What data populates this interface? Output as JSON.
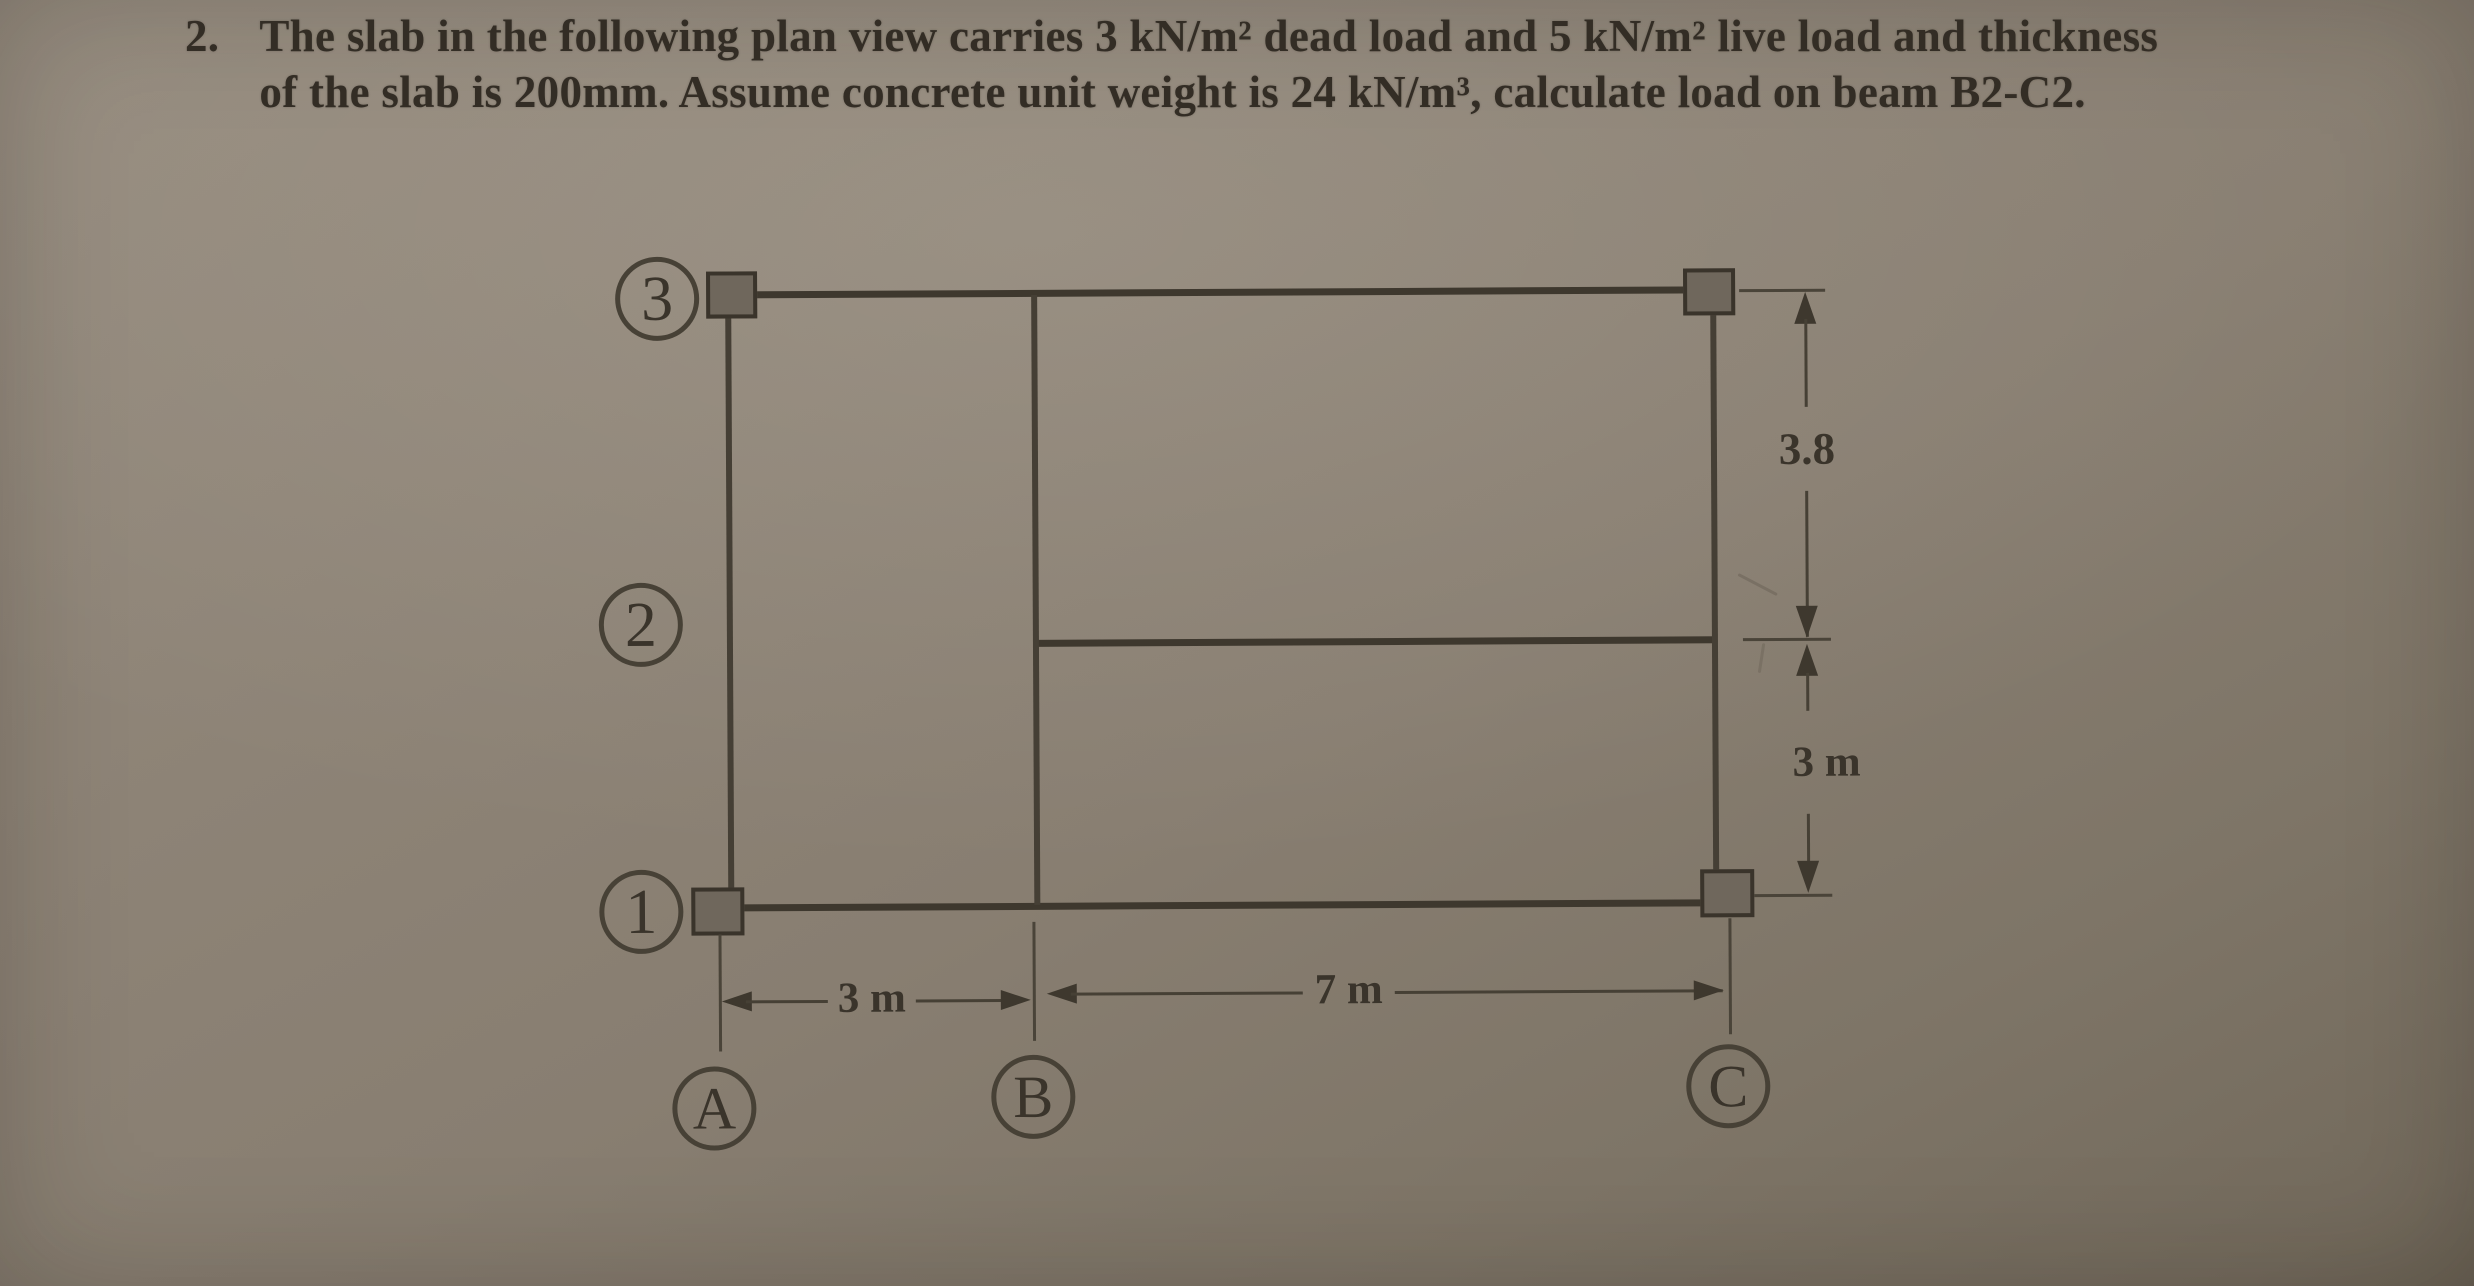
{
  "problem": {
    "number": "2.",
    "line1": "The slab in the following plan view carries 3 kN/m² dead load and 5 kN/m² live load and thickness",
    "line2": "of the slab is 200mm. Assume concrete unit weight is 24 kN/m³, calculate load on beam B2-C2."
  },
  "diagram": {
    "grid_bubbles": {
      "row3": "3",
      "row2": "2",
      "row1": "1",
      "colA": "A",
      "colB": "B",
      "colC": "C"
    },
    "dimensions": {
      "right_upper": "3.8",
      "right_lower": "3 m",
      "bottom_left": "3 m",
      "bottom_right": "7 m"
    },
    "colors": {
      "ink": "#3e382e",
      "paper": "#8b8174",
      "column_fill": "#6f675c"
    }
  }
}
